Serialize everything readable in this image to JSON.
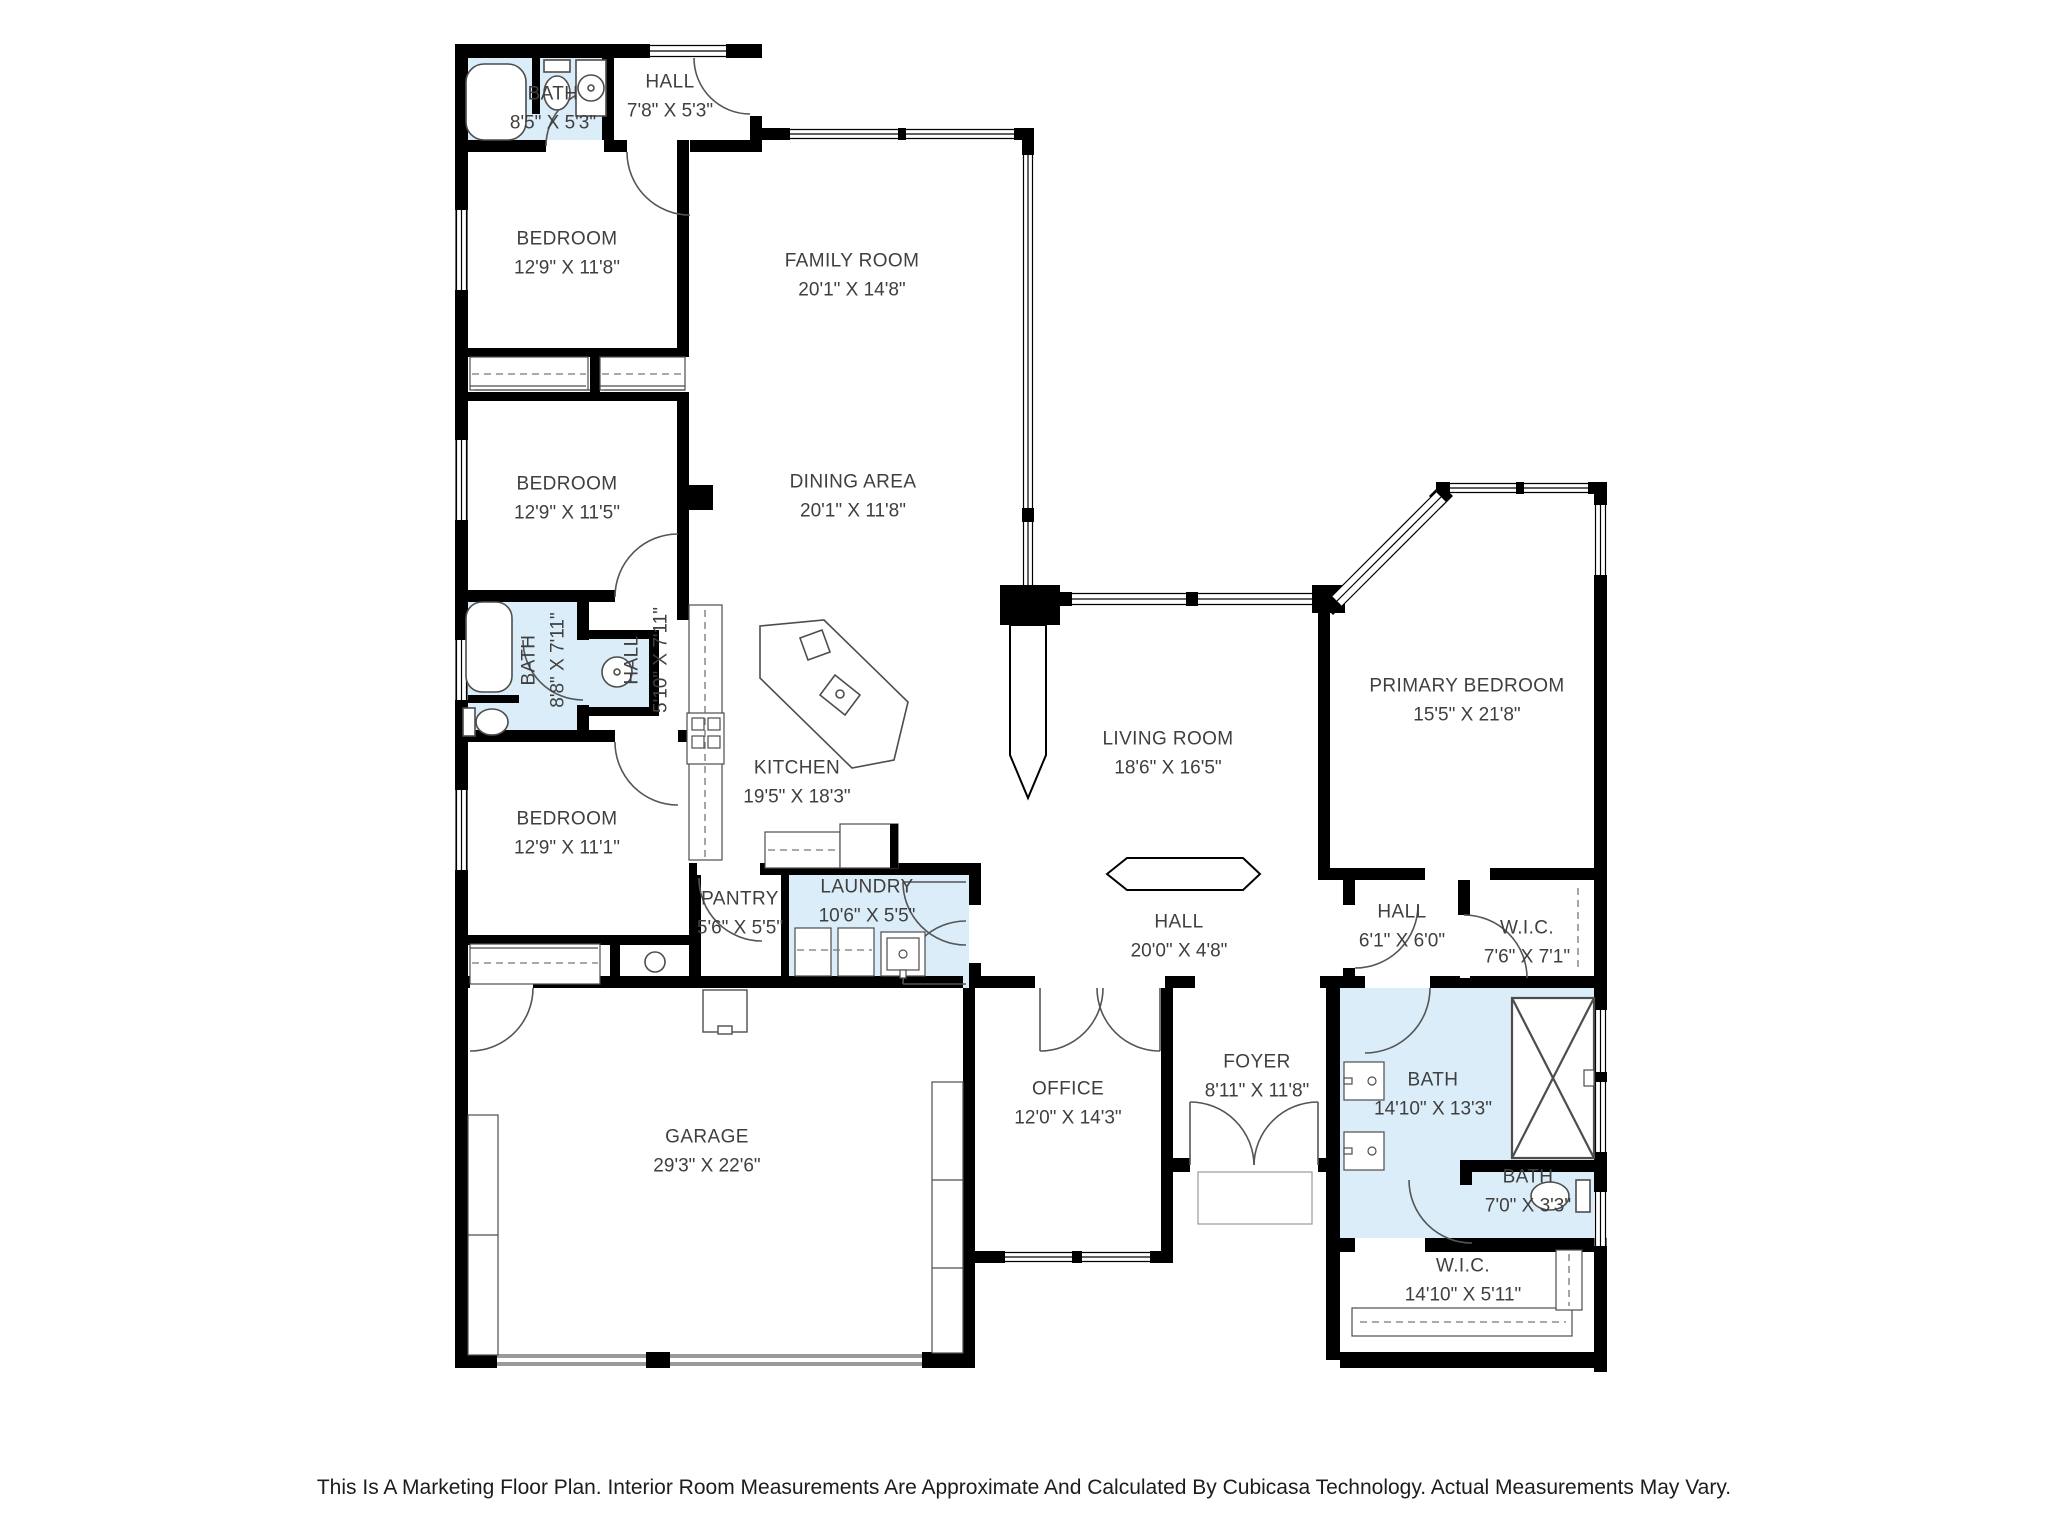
{
  "plan": {
    "footer": "This Is A Marketing Floor Plan. Interior Room Measurements Are Approximate And Calculated By Cubicasa Technology. Actual Measurements May Vary.",
    "colors": {
      "wall": "#000000",
      "wet_room_fill": "#daedf8",
      "label_text": "#3f3f3f"
    },
    "rooms": [
      {
        "name": "BATH",
        "dims": "8'5\" X 5'3\""
      },
      {
        "name": "HALL",
        "dims": "7'8\" X 5'3\""
      },
      {
        "name": "BEDROOM",
        "dims": "12'9\" X 11'8\""
      },
      {
        "name": "FAMILY ROOM",
        "dims": "20'1\" X 14'8\""
      },
      {
        "name": "BEDROOM",
        "dims": "12'9\" X 11'5\""
      },
      {
        "name": "DINING AREA",
        "dims": "20'1\" X 11'8\""
      },
      {
        "name": "BATH",
        "dims": "8'8\" X 7'11\""
      },
      {
        "name": "HALL",
        "dims": "5'10\" X 7'11\""
      },
      {
        "name": "KITCHEN",
        "dims": "19'5\" X 18'3\""
      },
      {
        "name": "LIVING ROOM",
        "dims": "18'6\" X 16'5\""
      },
      {
        "name": "PRIMARY BEDROOM",
        "dims": "15'5\" X 21'8\""
      },
      {
        "name": "BEDROOM",
        "dims": "12'9\" X 11'1\""
      },
      {
        "name": "PANTRY",
        "dims": "5'6\" X 5'5\""
      },
      {
        "name": "LAUNDRY",
        "dims": "10'6\" X 5'5\""
      },
      {
        "name": "HALL",
        "dims": "20'0\" X 4'8\""
      },
      {
        "name": "HALL",
        "dims": "6'1\" X 6'0\""
      },
      {
        "name": "W.I.C.",
        "dims": "7'6\" X 7'1\""
      },
      {
        "name": "GARAGE",
        "dims": "29'3\" X 22'6\""
      },
      {
        "name": "OFFICE",
        "dims": "12'0\" X 14'3\""
      },
      {
        "name": "FOYER",
        "dims": "8'11\" X 11'8\""
      },
      {
        "name": "BATH",
        "dims": "14'10\" X 13'3\""
      },
      {
        "name": "BATH",
        "dims": "7'0\" X 3'3\""
      },
      {
        "name": "W.I.C.",
        "dims": "14'10\" X 5'11\""
      }
    ]
  }
}
